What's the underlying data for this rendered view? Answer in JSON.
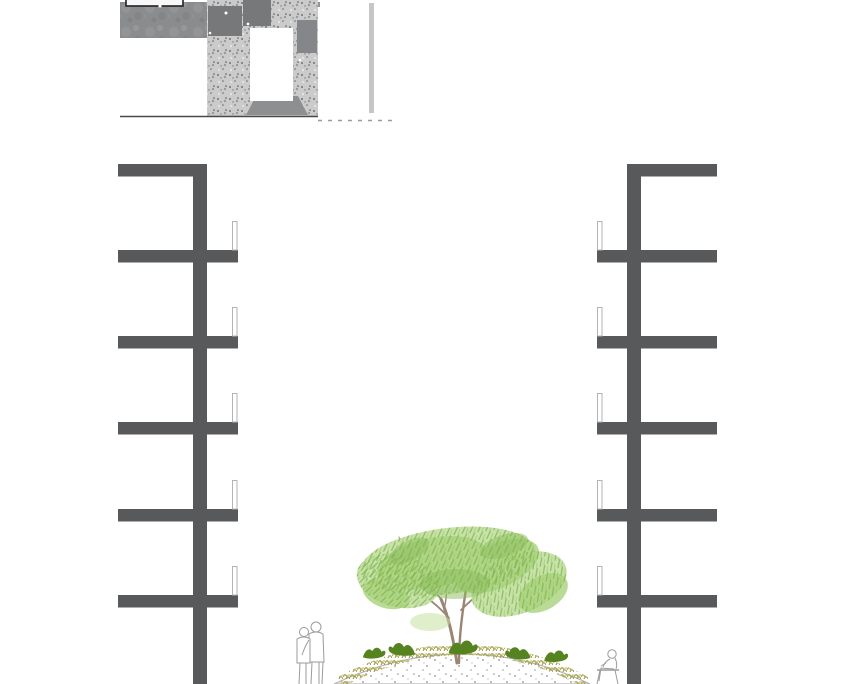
{
  "scene": {
    "description": "Architectural courtyard section drawing with grayscale site plan thumbnail, two mirrored building sections with balconies, and a sketched tree on a planted mound with people",
    "background": "#ffffff"
  },
  "colors": {
    "structure": "#58595b",
    "railing_fill": "#ffffff",
    "railing_stroke": "#b3b3b3",
    "plan_white": "#ffffff",
    "plan_dark_patch": "#77787a",
    "plan_mid_patch": "#85868a",
    "plan_road": "#8e8f91",
    "plan_strip": "#c6c6c6",
    "plan_frame": "#222222",
    "plan_ground_line": "#4a4a4a",
    "plan_dash_line": "#9a9a9a",
    "foliage_light": "#c3e1a0",
    "foliage_main": "#a9d37d",
    "foliage_dark": "#8cbd5e",
    "branch": "#9b8574",
    "shrub": "#55831f",
    "planting_strip": "#b0aa58",
    "mound_outline": "#b4b4b4",
    "mound_dot": "#8f8f8f",
    "figure_outline": "#9b9b9b",
    "figure_fill": "#ffffff"
  },
  "buildings": {
    "count": 2,
    "floor_slabs_per_building": 6,
    "balconies_per_building": 5
  },
  "site_plan": {
    "building_footprints": 3
  },
  "courtyard": {
    "tree_count": 1,
    "shrub_count": 5,
    "figures": [
      "standing couple",
      "seated person"
    ]
  }
}
